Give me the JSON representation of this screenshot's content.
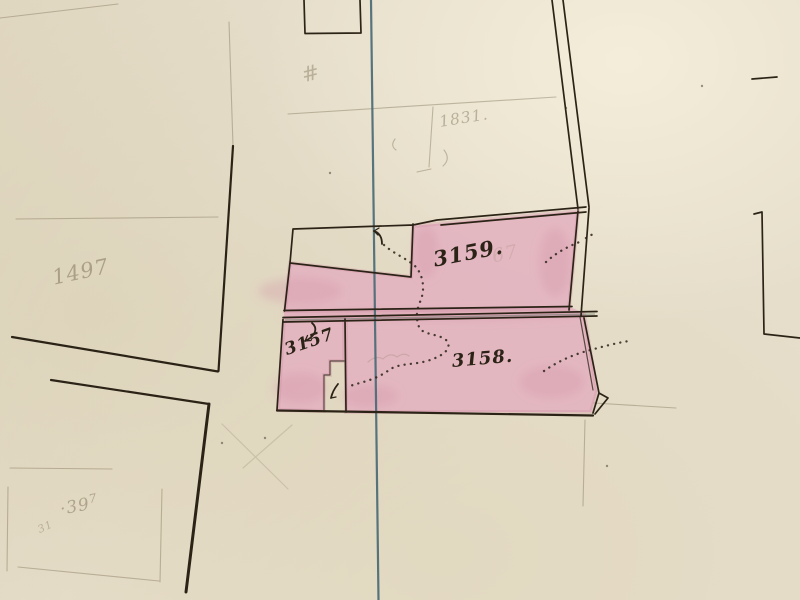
{
  "colors": {
    "paper": "#e6decb",
    "pink": "#e3b2bf",
    "pinkdeep": "#d190a4",
    "ink": "#2c2317",
    "pencil": "#7d7156",
    "blue": "#4a6a75",
    "street": "#5c7a66"
  },
  "map": {
    "kind": "hand-drawn cadastral plan scan",
    "parcels": [
      {
        "id": "3159",
        "label": "3159.",
        "shaded": true
      },
      {
        "id": "3158",
        "label": "3158.",
        "shaded": true
      },
      {
        "id": "3157",
        "label": "3157",
        "shaded": true
      },
      {
        "id": "1497",
        "label": "1497",
        "shaded": false
      },
      {
        "id": "1831",
        "label": "1831.",
        "shaded": false
      },
      {
        "id": "397",
        "label": "·39",
        "label_sup": "7",
        "shaded": false
      }
    ],
    "marks": {
      "hash": "#",
      "small_31": "31",
      "faint_67": "67"
    }
  }
}
